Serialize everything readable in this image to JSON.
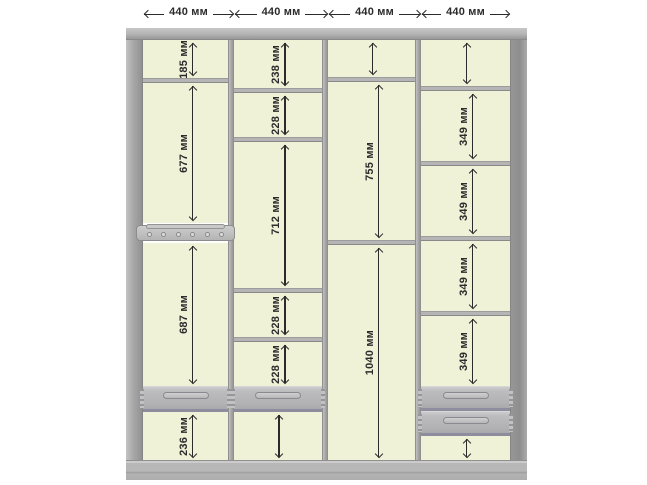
{
  "diagram": {
    "unit": "мм",
    "top_dimensions": [
      {
        "label": "440 мм"
      },
      {
        "label": "440 мм"
      },
      {
        "label": "440 мм"
      },
      {
        "label": "440 мм"
      }
    ],
    "columns": [
      {
        "name": "column-1",
        "width_label": "440 мм",
        "items": [
          {
            "type": "section",
            "h": 38,
            "label": "185 мм"
          },
          {
            "type": "shelf"
          },
          {
            "type": "section",
            "h": 140,
            "label": "677 мм"
          },
          {
            "type": "hanger"
          },
          {
            "type": "section",
            "h": 143,
            "label": "687 мм"
          },
          {
            "type": "drawer",
            "h": 26
          },
          {
            "type": "section",
            "h": 48,
            "label": "236 мм"
          }
        ]
      },
      {
        "name": "column-2",
        "width_label": "440 мм",
        "items": [
          {
            "type": "section",
            "h": 48,
            "label": "238 мм"
          },
          {
            "type": "shelf"
          },
          {
            "type": "section",
            "h": 44,
            "label": "228 мм"
          },
          {
            "type": "shelf"
          },
          {
            "type": "section",
            "h": 146,
            "label": "712 мм"
          },
          {
            "type": "shelf"
          },
          {
            "type": "section",
            "h": 44,
            "label": "228 мм"
          },
          {
            "type": "shelf"
          },
          {
            "type": "section",
            "h": 44,
            "label": "228 мм"
          },
          {
            "type": "drawer",
            "h": 26
          },
          {
            "type": "section",
            "h": 48,
            "label": ""
          }
        ]
      },
      {
        "name": "column-3",
        "width_label": "440 мм",
        "items": [
          {
            "type": "section",
            "h": 37,
            "label": ""
          },
          {
            "type": "shelf"
          },
          {
            "type": "section",
            "h": 158,
            "label": "755 мм"
          },
          {
            "type": "shelf"
          },
          {
            "type": "section",
            "h": 215,
            "label": "1040 мм"
          }
        ]
      },
      {
        "name": "column-4",
        "width_label": "440 мм",
        "items": [
          {
            "type": "section",
            "h": 46,
            "label": ""
          },
          {
            "type": "shelf"
          },
          {
            "type": "section",
            "h": 70,
            "label": "349 мм"
          },
          {
            "type": "shelf"
          },
          {
            "type": "section",
            "h": 70,
            "label": "349 мм"
          },
          {
            "type": "shelf"
          },
          {
            "type": "section",
            "h": 70,
            "label": "349 мм"
          },
          {
            "type": "shelf"
          },
          {
            "type": "section",
            "h": 70,
            "label": "349 мм"
          },
          {
            "type": "drawer",
            "h": 25
          },
          {
            "type": "drawer",
            "h": 25
          },
          {
            "type": "section",
            "h": 24,
            "label": ""
          }
        ]
      }
    ],
    "colors": {
      "interior": "#f0f2d8",
      "frame": "#b3b3b3",
      "frame_dark": "#8f8f8f",
      "shelf": "#b5b5b5",
      "drawer": "#b7b7b9",
      "drawer_accent": "#8d8d9e",
      "dimension_line": "#2b2b2b",
      "background": "#ffffff"
    }
  }
}
